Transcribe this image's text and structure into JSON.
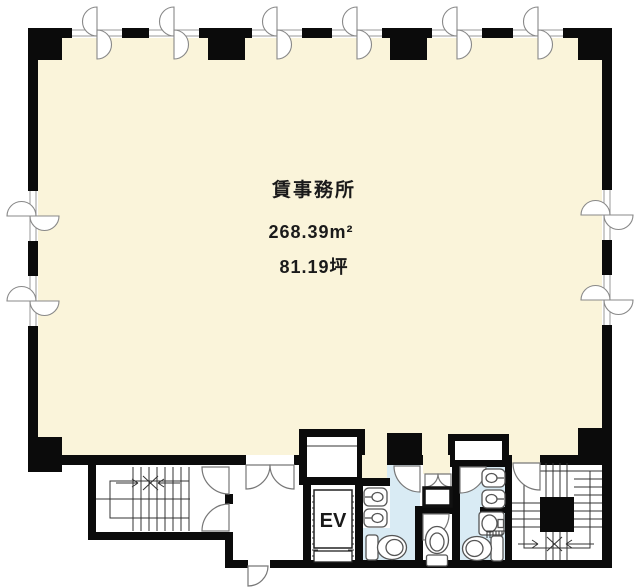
{
  "plan": {
    "room": {
      "name": "賃事務所",
      "area_m2": "268.39m²",
      "area_tsubo": "81.19坪"
    },
    "elevator_label": "EV",
    "colors": {
      "office_floor": "#faf4da",
      "wet_area_floor": "#d9ebf4",
      "wall": "#0b0b0b",
      "background": "#ffffff"
    },
    "icons": {
      "window": "window-icon",
      "door": "door-arc-icon",
      "stairs": "stairs-icon",
      "elevator": "elevator-car",
      "toilet": "toilet-icon",
      "urinal": "urinal-icon",
      "sink": "sink-icon"
    }
  }
}
